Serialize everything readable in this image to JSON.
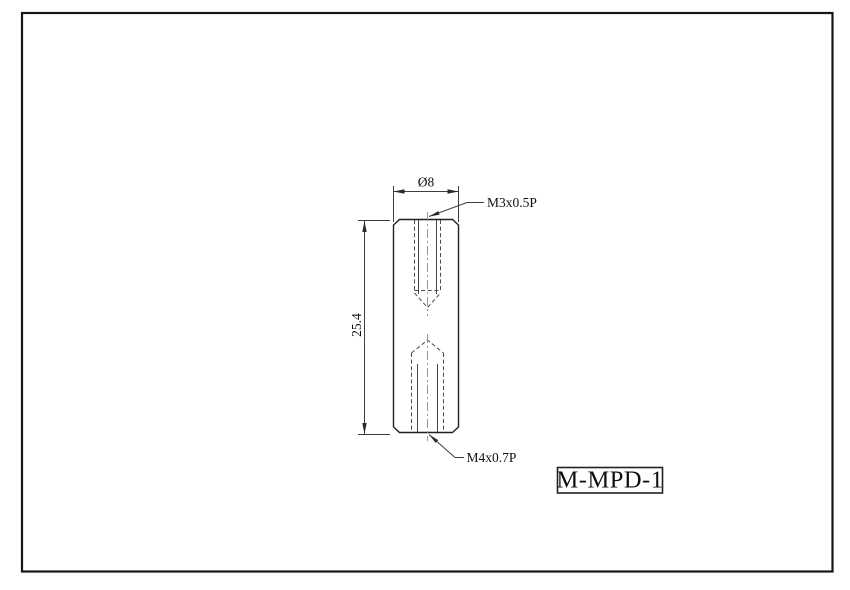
{
  "drawing": {
    "part_number": "M-MPD-1",
    "dimensions": {
      "diameter": "Ø8",
      "length": "25.4"
    },
    "thread_labels": {
      "top": "M3x0.5P",
      "bottom": "M4x0.7P"
    },
    "colors": {
      "background": "#ffffff",
      "outline": "#1f1f1f",
      "dimension_line": "#3d3d3d",
      "hidden_line": "#4a4a4a",
      "centerline": "#8c8c8c",
      "page_border": "#161616",
      "text": "#111111"
    }
  }
}
